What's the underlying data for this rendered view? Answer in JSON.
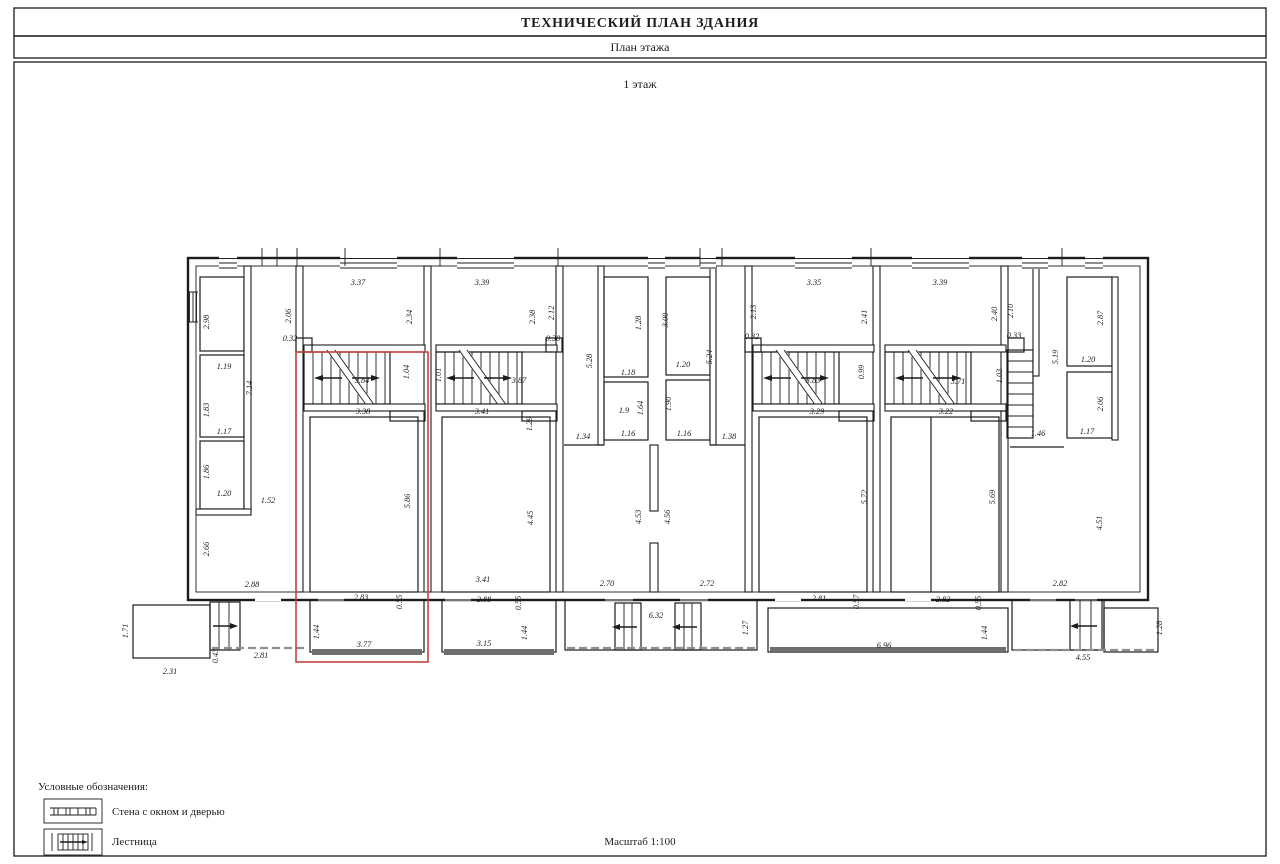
{
  "page": {
    "title": "ТЕХНИЧЕСКИЙ ПЛАН ЗДАНИЯ",
    "subtitle": "План этажа",
    "floor_label": "1 этаж"
  },
  "legend": {
    "heading": "Условные обозначения:",
    "items": [
      {
        "symbol": "wall-window-door-symbol",
        "label": "Стена с окном и дверью"
      },
      {
        "symbol": "stairs-symbol",
        "label": "Лестница"
      }
    ],
    "scale_label": "Масштаб 1:100"
  },
  "colors": {
    "wall": "#1c1c1c",
    "highlight": "#c24440",
    "hatch": "#6e6e6e",
    "background": "#ffffff"
  },
  "plan": {
    "highlight_rect": {
      "x": 296,
      "y": 352,
      "w": 132,
      "h": 310
    },
    "dimensions": [
      {
        "t": "2.98",
        "x": 209,
        "y": 322,
        "v": 1
      },
      {
        "t": "1.19",
        "x": 224,
        "y": 369
      },
      {
        "t": "7.14",
        "x": 252,
        "y": 388,
        "v": 1
      },
      {
        "t": "1.83",
        "x": 209,
        "y": 410,
        "v": 1
      },
      {
        "t": "1.17",
        "x": 224,
        "y": 434
      },
      {
        "t": "1.86",
        "x": 209,
        "y": 472,
        "v": 1
      },
      {
        "t": "1.20",
        "x": 224,
        "y": 496
      },
      {
        "t": "1.52",
        "x": 268,
        "y": 503
      },
      {
        "t": "2.66",
        "x": 209,
        "y": 549,
        "v": 1
      },
      {
        "t": "2.88",
        "x": 252,
        "y": 587
      },
      {
        "t": "1.71",
        "x": 128,
        "y": 631,
        "v": 1
      },
      {
        "t": "2.31",
        "x": 170,
        "y": 674
      },
      {
        "t": "0.43",
        "x": 218,
        "y": 656,
        "v": 1
      },
      {
        "t": "2.81",
        "x": 261,
        "y": 658
      },
      {
        "t": "2.06",
        "x": 291,
        "y": 316,
        "v": 1
      },
      {
        "t": "0.32",
        "x": 290,
        "y": 341
      },
      {
        "t": "3.37",
        "x": 358,
        "y": 285
      },
      {
        "t": "2.34",
        "x": 412,
        "y": 317,
        "v": 1
      },
      {
        "t": "3.84",
        "x": 362,
        "y": 383
      },
      {
        "t": "1.04",
        "x": 409,
        "y": 372,
        "v": 1
      },
      {
        "t": "3.38",
        "x": 363,
        "y": 414
      },
      {
        "t": "5.86",
        "x": 410,
        "y": 501,
        "v": 1
      },
      {
        "t": "2.83",
        "x": 361,
        "y": 600
      },
      {
        "t": "0.55",
        "x": 402,
        "y": 602,
        "v": 1
      },
      {
        "t": "1.44",
        "x": 319,
        "y": 632,
        "v": 1
      },
      {
        "t": "3.77",
        "x": 364,
        "y": 647
      },
      {
        "t": "3.39",
        "x": 482,
        "y": 285
      },
      {
        "t": "2.38",
        "x": 535,
        "y": 317,
        "v": 1
      },
      {
        "t": "2.12",
        "x": 554,
        "y": 313,
        "v": 1
      },
      {
        "t": "0.30",
        "x": 553,
        "y": 341
      },
      {
        "t": "1.01",
        "x": 441,
        "y": 375,
        "v": 1
      },
      {
        "t": "3.87",
        "x": 519,
        "y": 383
      },
      {
        "t": "3.41",
        "x": 482,
        "y": 414
      },
      {
        "t": "1.29",
        "x": 532,
        "y": 424,
        "v": 1
      },
      {
        "t": "4.45",
        "x": 533,
        "y": 518,
        "v": 1
      },
      {
        "t": "3.41",
        "x": 483,
        "y": 582
      },
      {
        "t": "2.88",
        "x": 484,
        "y": 602
      },
      {
        "t": "0.55",
        "x": 521,
        "y": 603,
        "v": 1
      },
      {
        "t": "1.44",
        "x": 527,
        "y": 633,
        "v": 1
      },
      {
        "t": "3.15",
        "x": 484,
        "y": 646
      },
      {
        "t": "5.28",
        "x": 592,
        "y": 361,
        "v": 1
      },
      {
        "t": "1.28",
        "x": 641,
        "y": 323,
        "v": 1
      },
      {
        "t": "1.18",
        "x": 628,
        "y": 375
      },
      {
        "t": "1.9",
        "x": 624,
        "y": 413,
        "s": 11
      },
      {
        "t": "1.64",
        "x": 643,
        "y": 408,
        "v": 1
      },
      {
        "t": "1.16",
        "x": 628,
        "y": 436
      },
      {
        "t": "1.34",
        "x": 583,
        "y": 439
      },
      {
        "t": "3.00",
        "x": 668,
        "y": 320,
        "v": 1
      },
      {
        "t": "1.20",
        "x": 683,
        "y": 367
      },
      {
        "t": "1.90",
        "x": 671,
        "y": 404,
        "v": 1
      },
      {
        "t": "1.16",
        "x": 684,
        "y": 436
      },
      {
        "t": "5.24",
        "x": 712,
        "y": 357,
        "v": 1
      },
      {
        "t": "1.38",
        "x": 729,
        "y": 439
      },
      {
        "t": "4.53",
        "x": 641,
        "y": 517,
        "v": 1
      },
      {
        "t": "4.56",
        "x": 670,
        "y": 517,
        "v": 1
      },
      {
        "t": "2.70",
        "x": 607,
        "y": 586
      },
      {
        "t": "2.72",
        "x": 707,
        "y": 586
      },
      {
        "t": "6.32",
        "x": 656,
        "y": 618
      },
      {
        "t": "1.27",
        "x": 748,
        "y": 628,
        "v": 1
      },
      {
        "t": "2.13",
        "x": 756,
        "y": 312,
        "v": 1
      },
      {
        "t": "0.32",
        "x": 752,
        "y": 339
      },
      {
        "t": "3.35",
        "x": 814,
        "y": 285
      },
      {
        "t": "2.41",
        "x": 867,
        "y": 317,
        "v": 1
      },
      {
        "t": "3.83",
        "x": 813,
        "y": 383
      },
      {
        "t": "0.99",
        "x": 864,
        "y": 372,
        "v": 1
      },
      {
        "t": "3.29",
        "x": 817,
        "y": 414
      },
      {
        "t": "5.72",
        "x": 867,
        "y": 497,
        "v": 1
      },
      {
        "t": "2.81",
        "x": 819,
        "y": 601
      },
      {
        "t": "0.57",
        "x": 859,
        "y": 602,
        "v": 1
      },
      {
        "t": "6.96",
        "x": 884,
        "y": 648
      },
      {
        "t": "3.39",
        "x": 940,
        "y": 285
      },
      {
        "t": "2.40",
        "x": 997,
        "y": 314,
        "v": 1
      },
      {
        "t": "2.10",
        "x": 1013,
        "y": 311,
        "v": 1
      },
      {
        "t": "0.33",
        "x": 1014,
        "y": 338
      },
      {
        "t": "3.71",
        "x": 958,
        "y": 384
      },
      {
        "t": "1.03",
        "x": 1002,
        "y": 376,
        "v": 1
      },
      {
        "t": "3.22",
        "x": 946,
        "y": 414
      },
      {
        "t": "5.69",
        "x": 995,
        "y": 497,
        "v": 1
      },
      {
        "t": "2.82",
        "x": 943,
        "y": 602
      },
      {
        "t": "0.55",
        "x": 981,
        "y": 603,
        "v": 1
      },
      {
        "t": "1.44",
        "x": 987,
        "y": 633,
        "v": 1
      },
      {
        "t": "5.19",
        "x": 1058,
        "y": 357,
        "v": 1
      },
      {
        "t": "2.87",
        "x": 1103,
        "y": 318,
        "v": 1
      },
      {
        "t": "1.20",
        "x": 1088,
        "y": 362
      },
      {
        "t": "2.06",
        "x": 1103,
        "y": 404,
        "v": 1
      },
      {
        "t": "1.17",
        "x": 1087,
        "y": 434
      },
      {
        "t": "1.46",
        "x": 1038,
        "y": 436
      },
      {
        "t": "4.51",
        "x": 1102,
        "y": 523,
        "v": 1
      },
      {
        "t": "2.82",
        "x": 1060,
        "y": 586
      },
      {
        "t": "4.55",
        "x": 1083,
        "y": 660
      },
      {
        "t": "1.28",
        "x": 1162,
        "y": 628,
        "v": 1
      }
    ]
  }
}
